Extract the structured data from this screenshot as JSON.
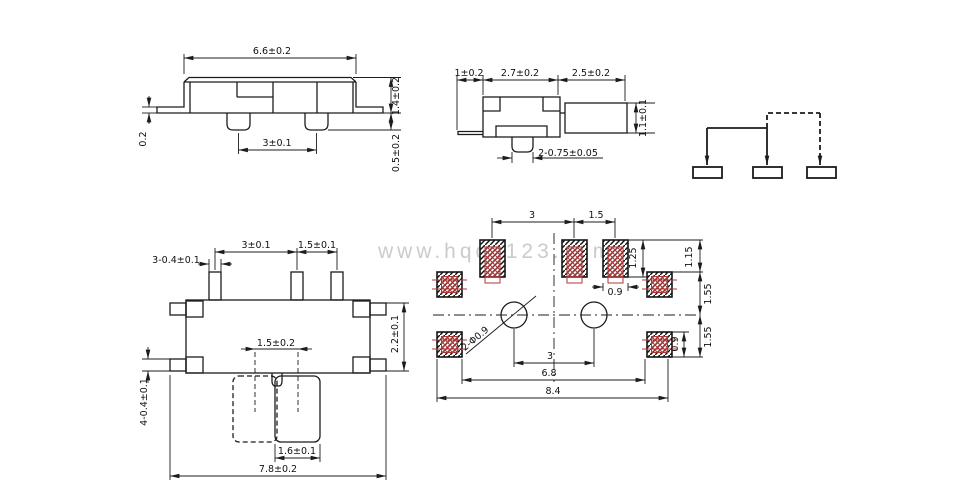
{
  "watermark": {
    "text": "www.hqdz123.com"
  },
  "colors": {
    "line": "#1c1c1c",
    "red_overlay": "#b03535",
    "watermark": "#cbcbcb",
    "background": "#ffffff"
  },
  "side_view": {
    "dims": {
      "total_width": "6.6±0.2",
      "body_height": "1.4±0.2",
      "foot_thickness": "0.2",
      "pin_pitch": "3±0.1",
      "pin_depth": "0.5±0.2"
    }
  },
  "end_view": {
    "dims": {
      "terminal_length": "1±0.2",
      "body_width": "2.7±0.2",
      "lever_length": "2.5±0.2",
      "lever_height": "1.1±0.1",
      "pin_spec": "2-0.75±0.05"
    }
  },
  "top_view": {
    "dims": {
      "pin_pitch_a": "3±0.1",
      "pin_pitch_b": "1.5±0.1",
      "pin_width": "3-0.4±0.1",
      "body_depth": "2.2±0.1",
      "knob_travel": "1.5±0.2",
      "corner_pad": "4-0.4±0.1",
      "knob_width": "1.6±0.1",
      "total_width": "7.8±0.2"
    }
  },
  "land_pattern": {
    "dims": {
      "pad_pitch_a": "3",
      "pad_pitch_b": "1.5",
      "pad_height": "1.25",
      "pad_width": "0.9",
      "edge_gap": "1.15",
      "row_gap_upper": "1.55",
      "row_gap_lower": "1.55",
      "corner_pad_height": "0.9",
      "holes": "2-Φ0.9",
      "hole_pitch": "3",
      "inner_span": "6.8",
      "outer_span": "8.4"
    }
  }
}
